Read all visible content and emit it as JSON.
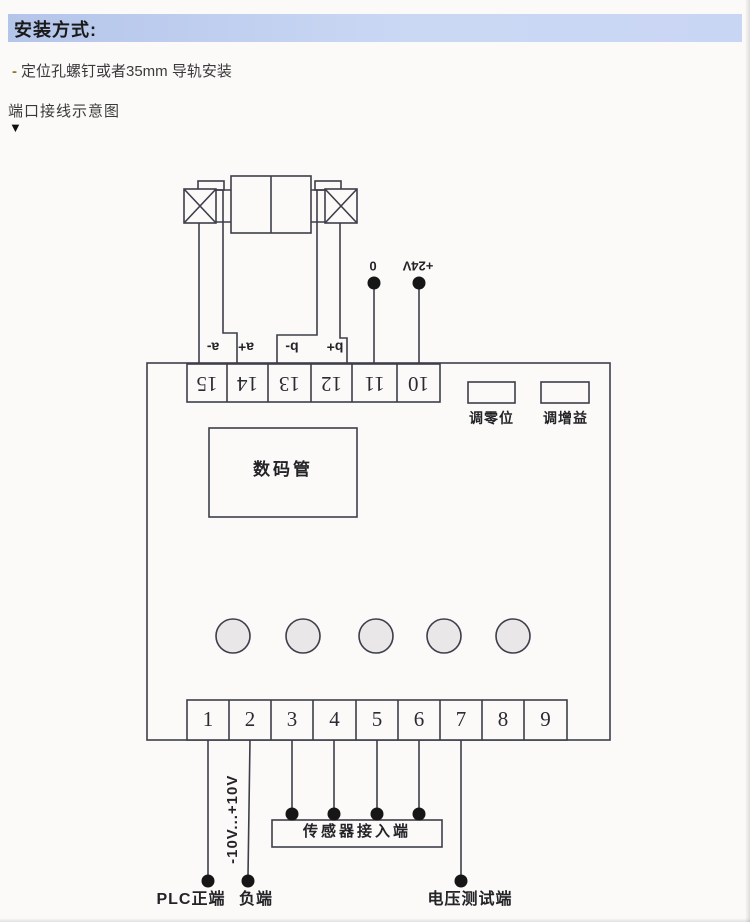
{
  "page": {
    "title": "安装方式:",
    "bullet": {
      "dash": "-",
      "text": "定位孔螺钉或者35mm 导轨安装"
    },
    "diagram_caption": "端口接线示意图",
    "caption_arrow": "▼"
  },
  "diagram": {
    "top_terminals": {
      "numbers": [
        "15",
        "14",
        "13",
        "12",
        "11",
        "10"
      ],
      "wire_labels": [
        "a-",
        "a+",
        "b-",
        "b+"
      ],
      "power_labels": [
        "0",
        "+24V"
      ]
    },
    "pots": [
      {
        "label": "调零位"
      },
      {
        "label": "调增益"
      }
    ],
    "display": {
      "label": "数码管"
    },
    "buttons_count": 5,
    "bottom_terminals": {
      "numbers": [
        "1",
        "2",
        "3",
        "4",
        "5",
        "6",
        "7",
        "8",
        "9"
      ]
    },
    "annotations": {
      "range_label": "-10V...+10V",
      "sensor_box_label": "传感器接入端",
      "plc_positive_label": "PLC正端",
      "negative_label": "负端",
      "voltage_test_label": "电压测试端"
    },
    "colors": {
      "line": "#3e3e4a",
      "button_fill": "#eae7e9",
      "header_bar": "#c3d1f0",
      "dot": "#161616"
    }
  }
}
